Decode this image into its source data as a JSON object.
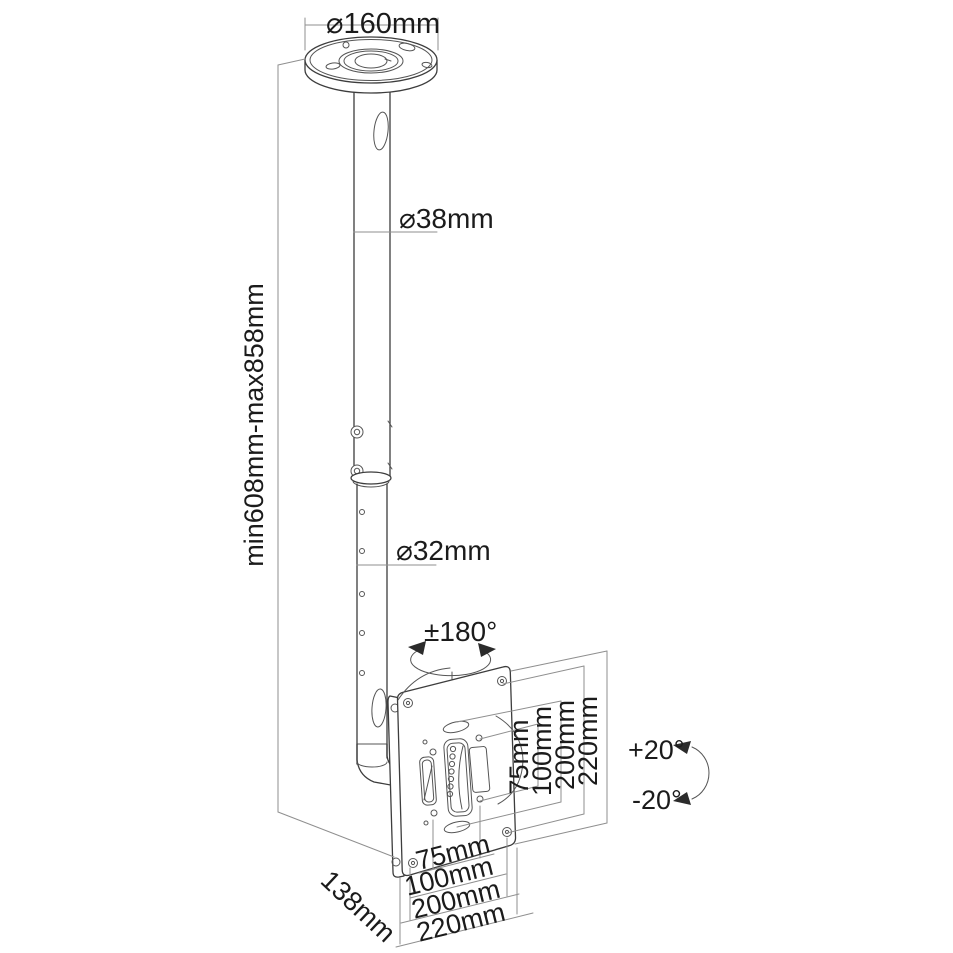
{
  "drawing": {
    "type": "technical-dimension-drawing",
    "subject": "ceiling TV mount with telescopic pole and VESA plate"
  },
  "colors": {
    "background": "#ffffff",
    "object_line": "#3d3d3d",
    "detail_line": "#555555",
    "construction_line": "#8f8f8f",
    "text": "#1b1b1b"
  },
  "dimensions": {
    "ceiling_plate_diameter": "⌀160mm",
    "upper_pole_diameter": "⌀38mm",
    "height_range": "min608mm-max858mm",
    "lower_pole_diameter": "⌀32mm",
    "swivel_range": "±180°",
    "tilt_up": "+20°",
    "tilt_down": "-20°",
    "mount_depth": "138mm",
    "vesa_vertical": [
      "75mm",
      "100mm",
      "200mm",
      "220mm"
    ],
    "vesa_horizontal": [
      "75mm",
      "100mm",
      "200mm",
      "220mm"
    ]
  }
}
